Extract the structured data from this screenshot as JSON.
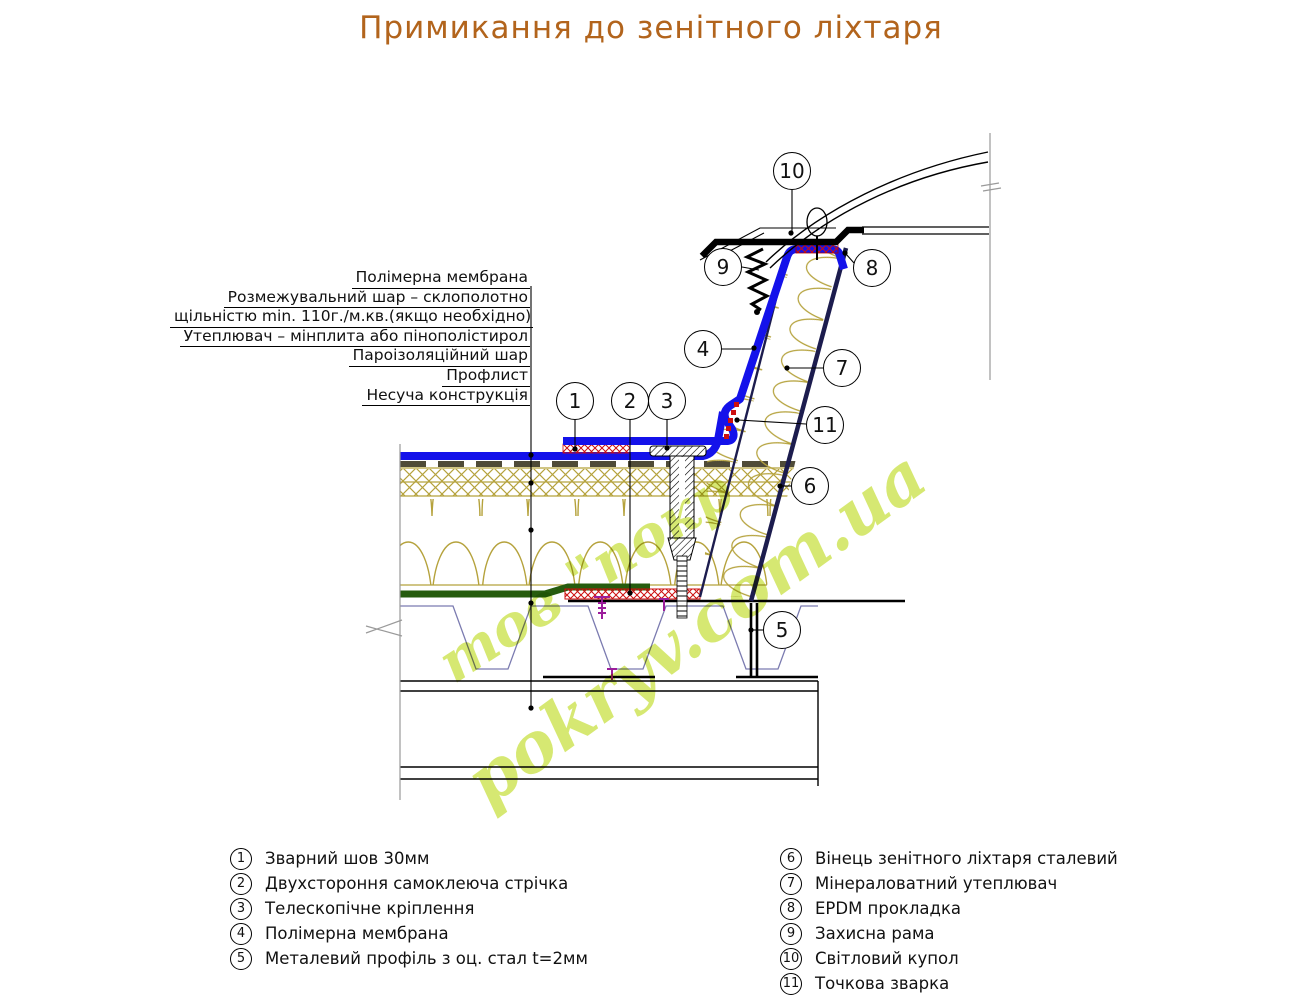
{
  "title": "Примикання до зенітного ліхтаря",
  "layer_labels": [
    "Полімерна мембрана",
    "Розмежувальний шар – склополотно",
    "щільністю min. 110г./м.кв.(якщо необхідно)",
    "Утеплювач – мінплита або пінополістирол",
    "Пароізоляційний шар",
    "Профлист",
    "Несуча конструкція"
  ],
  "legend": {
    "left": [
      {
        "num": "1",
        "label": "Зварний шов 30мм"
      },
      {
        "num": "2",
        "label": "Двухстороння самоклеюча стрічка"
      },
      {
        "num": "3",
        "label": "Телескопічне кріплення"
      },
      {
        "num": "4",
        "label": "Полімерна мембрана"
      },
      {
        "num": "5",
        "label": "Металевий профіль з оц. стал t=2мм"
      }
    ],
    "right": [
      {
        "num": "6",
        "label": "Вінець зенітного ліхтаря сталевий"
      },
      {
        "num": "7",
        "label": "Мінераловатний утеплювач"
      },
      {
        "num": "8",
        "label": "EPDM прокладка"
      },
      {
        "num": "9",
        "label": "Захисна рама"
      },
      {
        "num": "10",
        "label": "Світловий купол"
      },
      {
        "num": "11",
        "label": "Точкова зварка"
      }
    ]
  },
  "watermark": {
    "line1": "тов \"покр",
    "line2": "pokryv.com.ua"
  },
  "colors": {
    "title": "#b2641c",
    "membrane_blue": "#1412ea",
    "curb_steel_navy": "#1c1c4e",
    "insulation_tan": "#b5a23c",
    "vapor_barrier_green": "#265c0e",
    "seal_red": "#cc0f0f",
    "proflist_slate": "#7b7bb0",
    "screw_purple": "#9b1d9b",
    "watermark_lime": "#cbe24a"
  }
}
